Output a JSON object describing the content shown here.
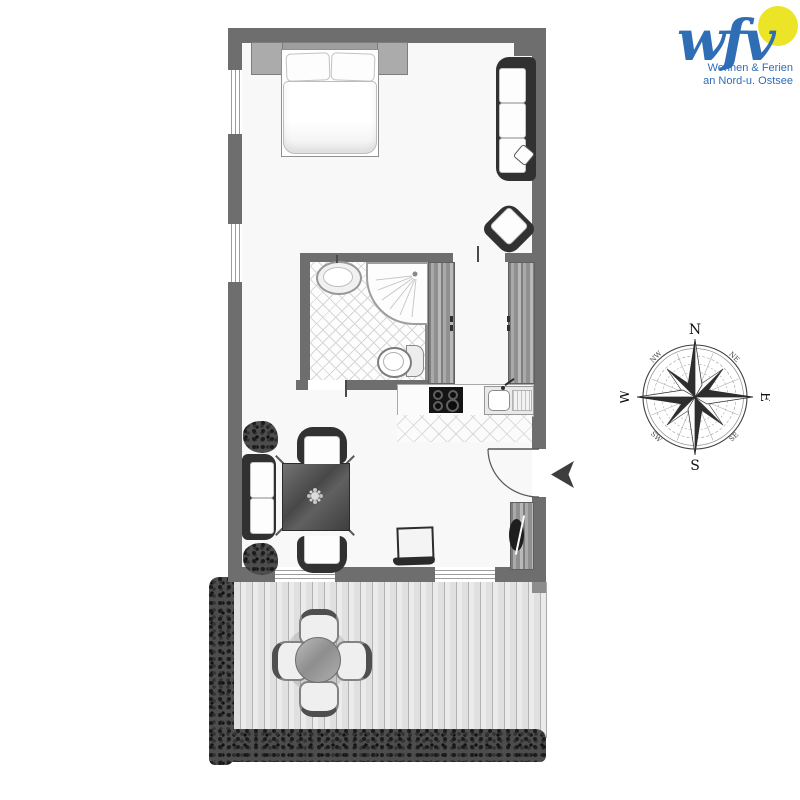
{
  "logo": {
    "brand": "wfv",
    "tagline_line1": "Wohnen & Ferien",
    "tagline_line2": "an Nord-u. Ostsee",
    "brand_color": "#2f6db5",
    "sun_color": "#ece426"
  },
  "compass": {
    "n": "N",
    "e": "E",
    "s": "S",
    "w": "W",
    "ne": "NE",
    "nw": "NW",
    "se": "SE",
    "sw": "SW"
  },
  "palette": {
    "wall": "#6e6e6e",
    "furniture_dark": "#313131",
    "deck": "#e8e8e8",
    "hedge": "#4d4d4d",
    "tile_line": "#d7d7d7"
  },
  "floorplan": {
    "rooms": [
      "bedroom-living-room",
      "bathroom",
      "closet-hallway",
      "kitchenette",
      "living-dining-area",
      "terrace"
    ],
    "furniture": [
      "double-bed",
      "nightstand",
      "headboard",
      "three-seat-sofa",
      "corner-armchair",
      "washbasin",
      "shower",
      "toilet",
      "wardrobe",
      "stove",
      "kitchen-sink",
      "dining-table",
      "armchair",
      "two-seat-sofa",
      "plant",
      "side-chair",
      "tv-sideboard",
      "entrance-door",
      "terrace-table",
      "terrace-chair",
      "hedge"
    ]
  }
}
